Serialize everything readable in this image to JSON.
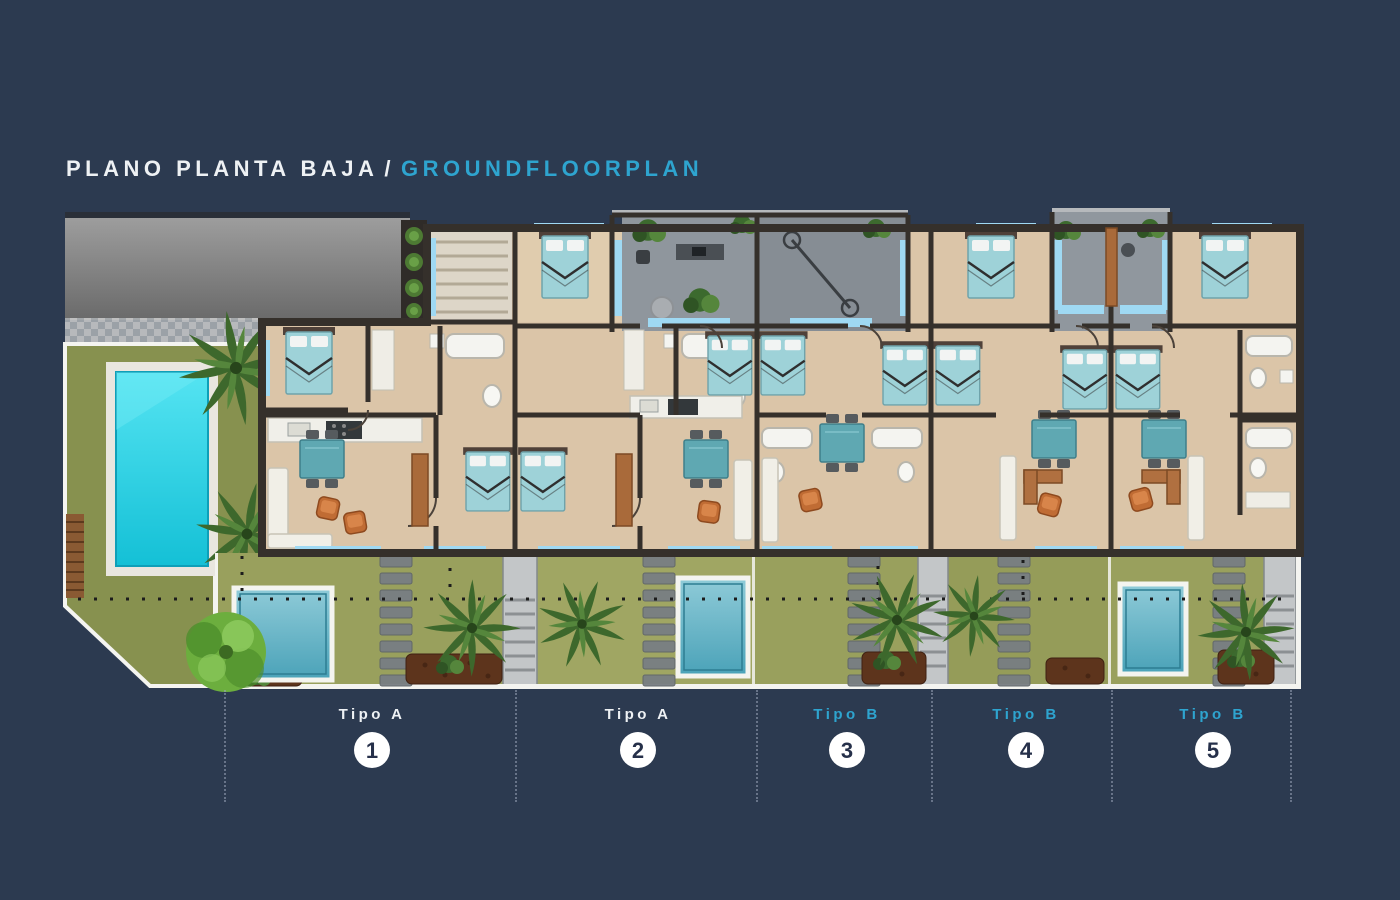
{
  "title": {
    "primary": "PLANO PLANTA BAJA",
    "separator": "/",
    "secondary": "GROUNDFLOORPLAN"
  },
  "units": [
    {
      "type": "Tipo A",
      "number": "1"
    },
    {
      "type": "Tipo A",
      "number": "2"
    },
    {
      "type": "Tipo B",
      "number": "3"
    },
    {
      "type": "Tipo B",
      "number": "4"
    },
    {
      "type": "Tipo B",
      "number": "5"
    }
  ],
  "colors": {
    "bg": "#2c3a50",
    "accent": "#2ea4cf",
    "text": "#eef1f4",
    "circle_fill": "#ffffff",
    "circle_number": "#26304a",
    "divider": "#9aa5b8",
    "wall": "#35302b",
    "floor": "#dbc5a8",
    "garden_dark": "#84904e",
    "garden_light": "#99a05d",
    "pool": "#2ed4e6",
    "plunge_pool": "#5fb3c6",
    "bed": "#9ed2d8",
    "window": "#9fd9f3",
    "terrace": "#8b8b8b",
    "patio": "#8d949b",
    "wood": "#a96a3a",
    "furniture_orange": "#c06c34",
    "furniture_white": "#f1efe7",
    "walkway": "#c3c6c8",
    "mulch": "#5d341c",
    "palm": "#3d682c",
    "tree": "#6cae3e"
  }
}
